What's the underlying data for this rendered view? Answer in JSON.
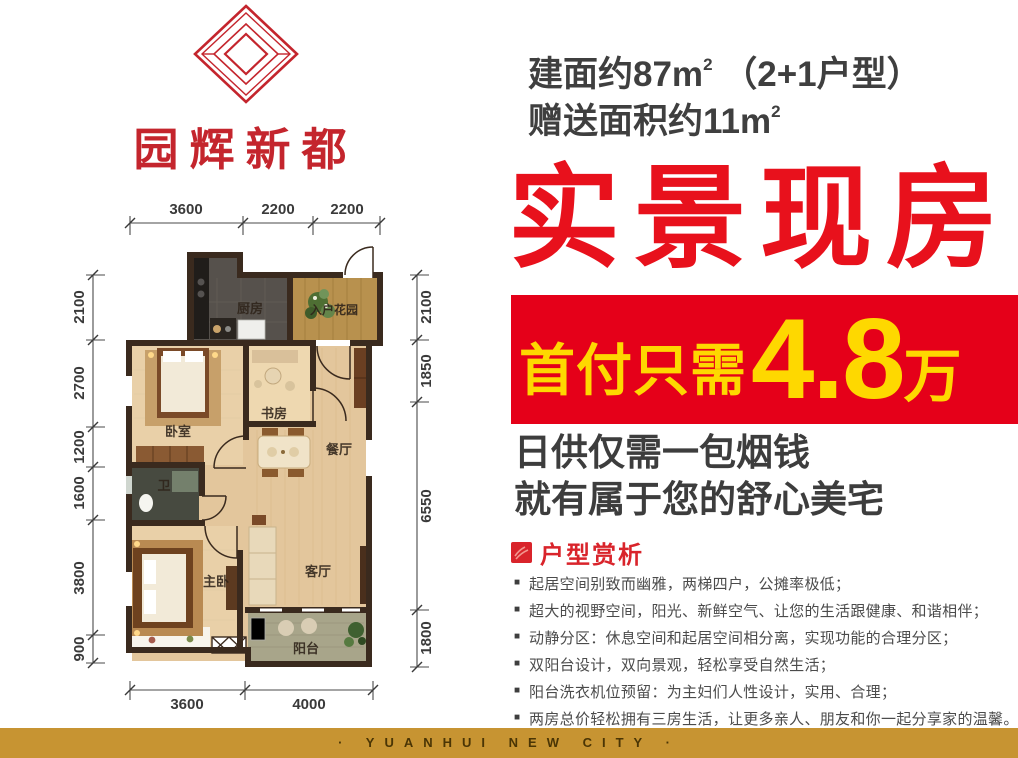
{
  "logo": {
    "name": "园辉新都",
    "icon": "nested-diamond-logo",
    "color": "#c4252d"
  },
  "header": {
    "area_line1": {
      "text": "建面约87m",
      "sup": "2",
      "rest": " （2+1户型）"
    },
    "area_line2": {
      "text": "赠送面积约11m",
      "sup": "2"
    },
    "headline": "实景现房",
    "banner": {
      "prefix": "首付只需",
      "amount": "4.8",
      "unit": "万"
    },
    "subline1": "日供仅需一包烟钱",
    "subline2": "就有属于您的舒心美宅"
  },
  "analysis": {
    "icon": "red-square-seal-icon",
    "title": "户型赏析",
    "marker": "■",
    "bullets": [
      "起居空间别致而幽雅，两梯四户，公摊率极低；",
      "超大的视野空间，阳光、新鲜空气、让您的生活跟健康、和谐相伴；",
      "动静分区：休息空间和起居空间相分离，实现功能的合理分区；",
      "双阳台设计，双向景观，轻松享受自然生活；",
      "阳台洗衣机位预留：为主妇们人性设计，实用、合理；",
      "两房总价轻松拥有三房生活，让更多亲人、朋友和你一起分享家的温馨。"
    ]
  },
  "floorplan": {
    "rooms": {
      "kitchen": "厨房",
      "garden": "入户花园",
      "bedroom": "卧室",
      "study": "书房",
      "dining": "餐厅",
      "bath": "卫",
      "master": "主卧",
      "living": "客厅",
      "balcony": "阳台"
    },
    "dims": {
      "top": [
        "3600",
        "2200",
        "2200"
      ],
      "left": [
        "2100",
        "2700",
        "1200",
        "1600",
        "3800",
        "900"
      ],
      "right": [
        "2100",
        "1850",
        "6550",
        "1800"
      ],
      "bottom": [
        "3600",
        "4000"
      ]
    }
  },
  "footer": {
    "text": "· YUANHUI NEW CITY ·"
  },
  "colors": {
    "headline_red": "#e8111c",
    "banner_red": "#e50019",
    "banner_yellow": "#fed800",
    "logo_red": "#c4252d",
    "analysis_red": "#d9242b",
    "wall_brown": "#3a2a1e",
    "gold_band": "#c79432"
  }
}
